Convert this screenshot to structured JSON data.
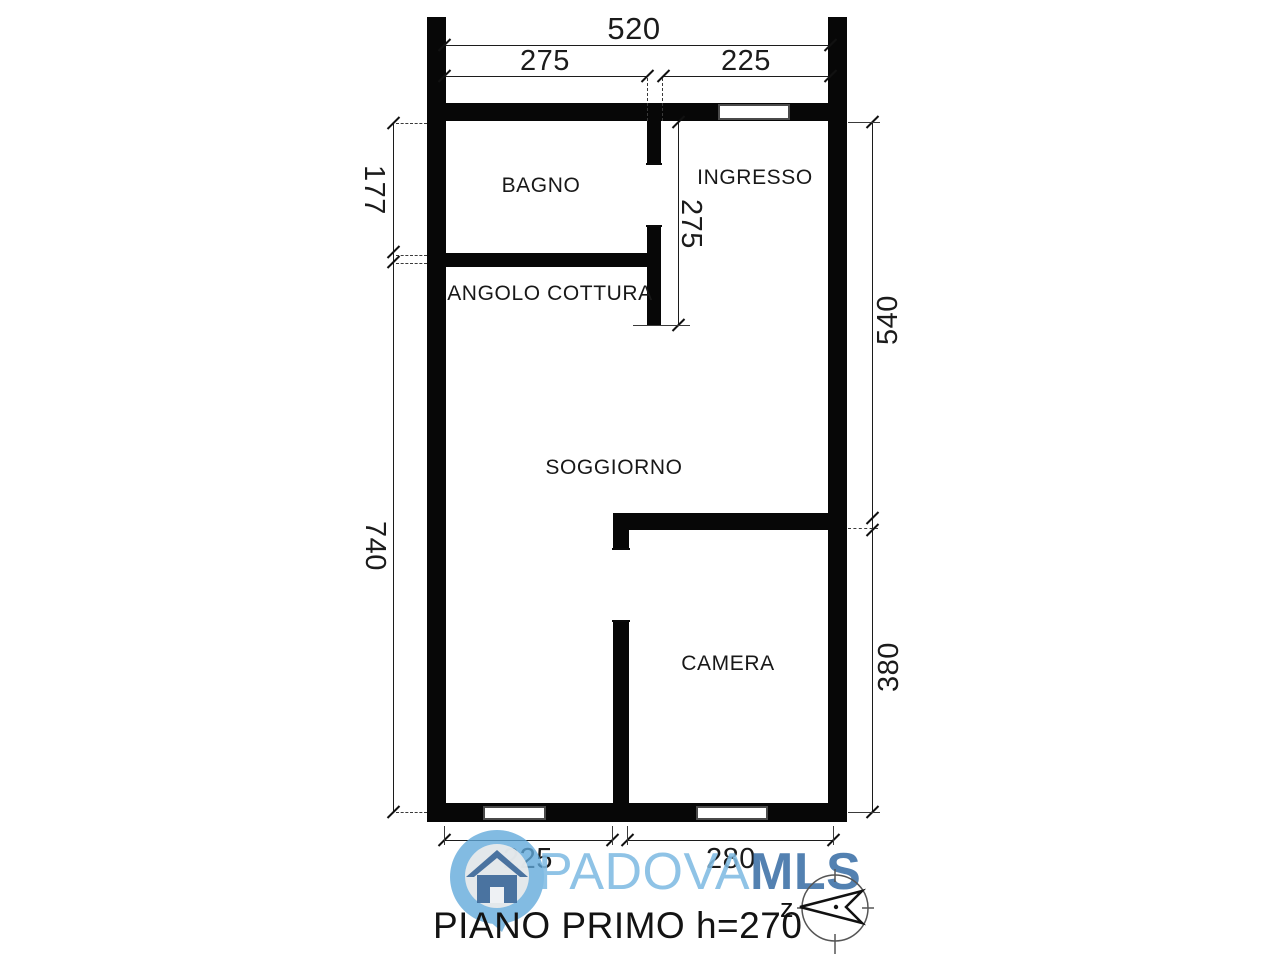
{
  "title": "PIANO PRIMO h=270",
  "rooms": {
    "bagno": "BAGNO",
    "ingresso": "INGRESSO",
    "angolo_cottura": "ANGOLO COTTURA",
    "soggiorno": "SOGGIORNO",
    "camera": "CAMERA"
  },
  "dimensions": {
    "top_total": "520",
    "top_left": "275",
    "top_right": "225",
    "left_upper": "177",
    "left_lower": "740",
    "inner_vertical": "275",
    "right_upper": "540",
    "right_lower": "380",
    "bottom_left": "225",
    "bottom_right": "280"
  },
  "watermark": {
    "brand_light": "PADOVA",
    "brand_bold": "MLS"
  },
  "compass": {
    "label": "z"
  },
  "colors": {
    "wall": "#070707",
    "brand_light_blue": "#80bbe3",
    "brand_dark_blue": "#4476aa",
    "pin_blue": "#5fa8da",
    "house_blue": "#3d6899"
  }
}
